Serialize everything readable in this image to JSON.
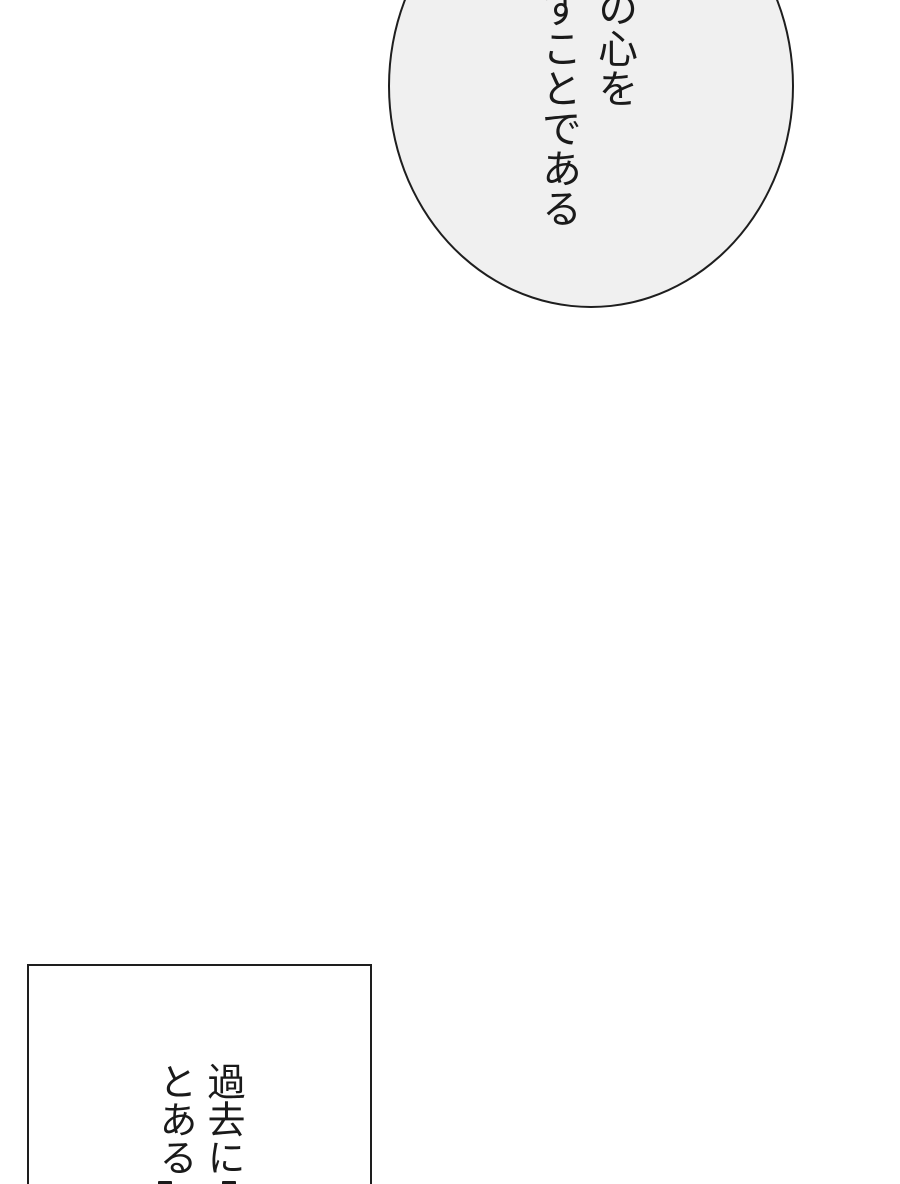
{
  "page_kind": "manga-page",
  "colors": {
    "page-bg": "#ffffff",
    "bubble-fill": "#f0f0f0",
    "panel-fill": "#ffffff",
    "line-color": "#1e1e1e",
    "text-color": "#1a1a1a"
  },
  "speech_bubble": {
    "writing_mode": "vertical-rl",
    "columns": [
      "の心を",
      "すことである"
    ],
    "text": "の心を すことである"
  },
  "caption_panel": {
    "writing_mode": "vertical-rl",
    "columns": [
      "過去に",
      "とある"
    ],
    "text": "過去に とある"
  }
}
